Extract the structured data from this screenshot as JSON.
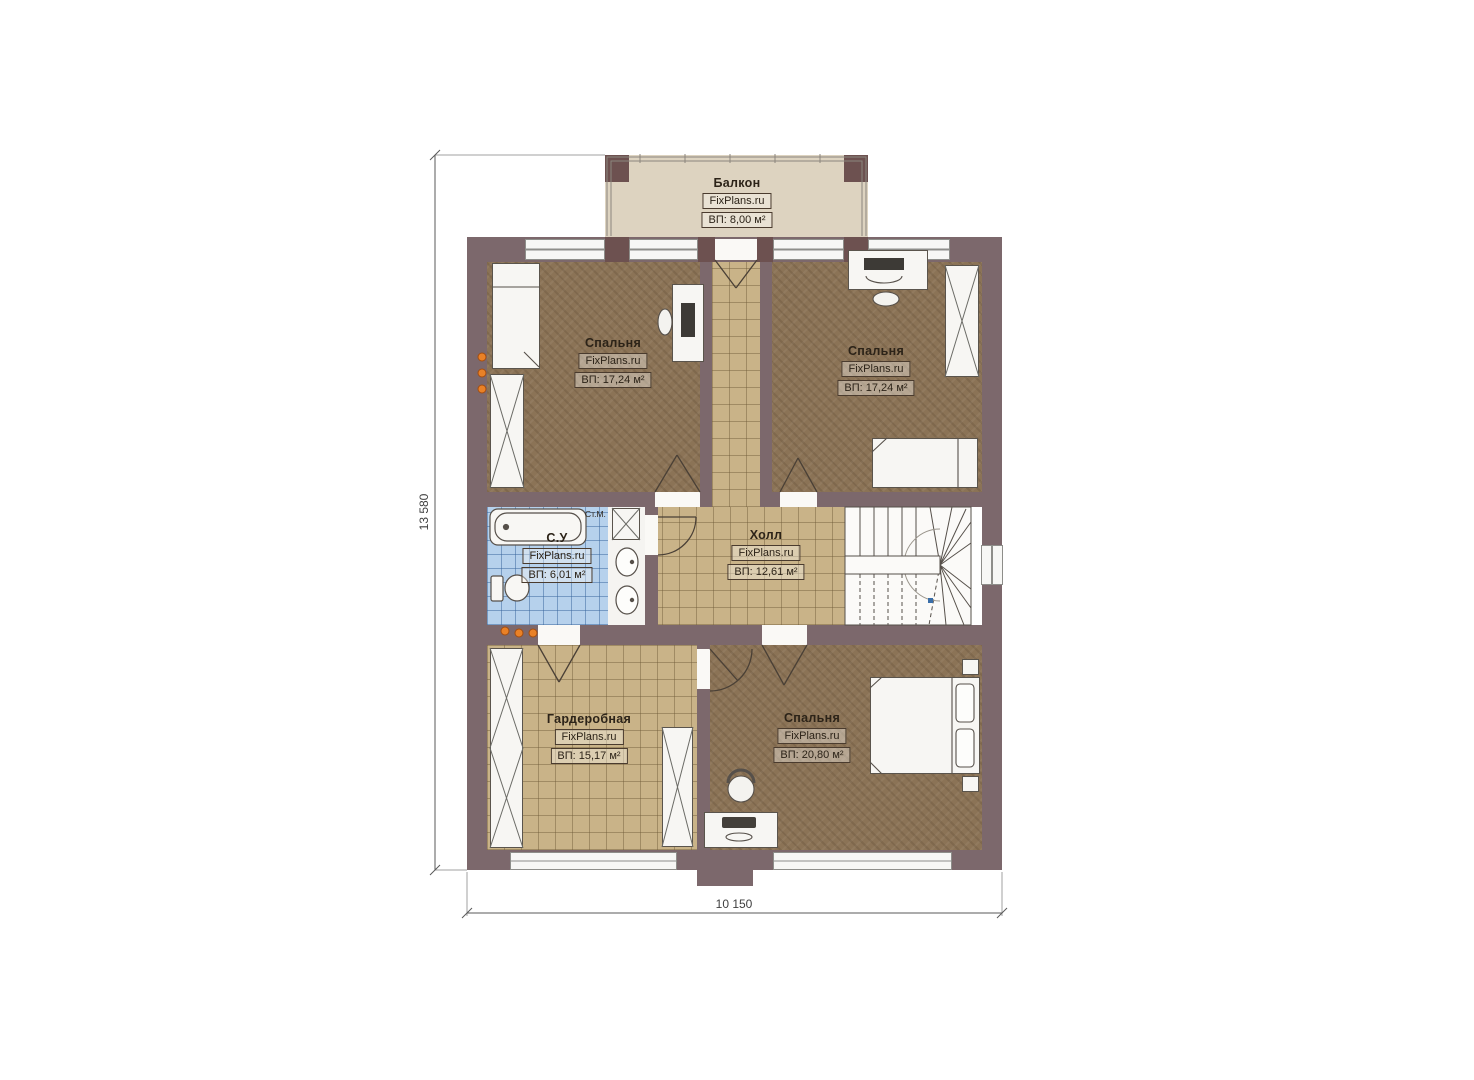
{
  "rooms": {
    "balcony": {
      "name": "Балкон",
      "brand": "FixPlans.ru",
      "area": "ВП: 8,00 м²"
    },
    "bedroom_tl": {
      "name": "Спальня",
      "brand": "FixPlans.ru",
      "area": "ВП: 17,24 м²"
    },
    "bedroom_tr": {
      "name": "Спальня",
      "brand": "FixPlans.ru",
      "area": "ВП: 17,24 м²"
    },
    "bathroom": {
      "name": "С.У",
      "brand": "FixPlans.ru",
      "area": "ВП: 6,01 м²"
    },
    "hall": {
      "name": "Холл",
      "brand": "FixPlans.ru",
      "area": "ВП: 12,61 м²"
    },
    "wardrobe": {
      "name": "Гардеробная",
      "brand": "FixPlans.ru",
      "area": "ВП: 15,17 м²"
    },
    "bedroom_b": {
      "name": "Спальня",
      "brand": "FixPlans.ru",
      "area": "ВП: 20,80 м²"
    }
  },
  "dimensions": {
    "vertical": "13 580",
    "horizontal": "10 150"
  },
  "annotations": {
    "washing_machine": "Ст.М."
  },
  "colors": {
    "wall": "#7c686c",
    "post": "#6d5150",
    "carpet": "#8b7356",
    "tile": "#c9b388",
    "bath_tile": "#b6d1ec",
    "balcony_floor": "#ddd3c0",
    "radiator_orange": "#e98127"
  }
}
